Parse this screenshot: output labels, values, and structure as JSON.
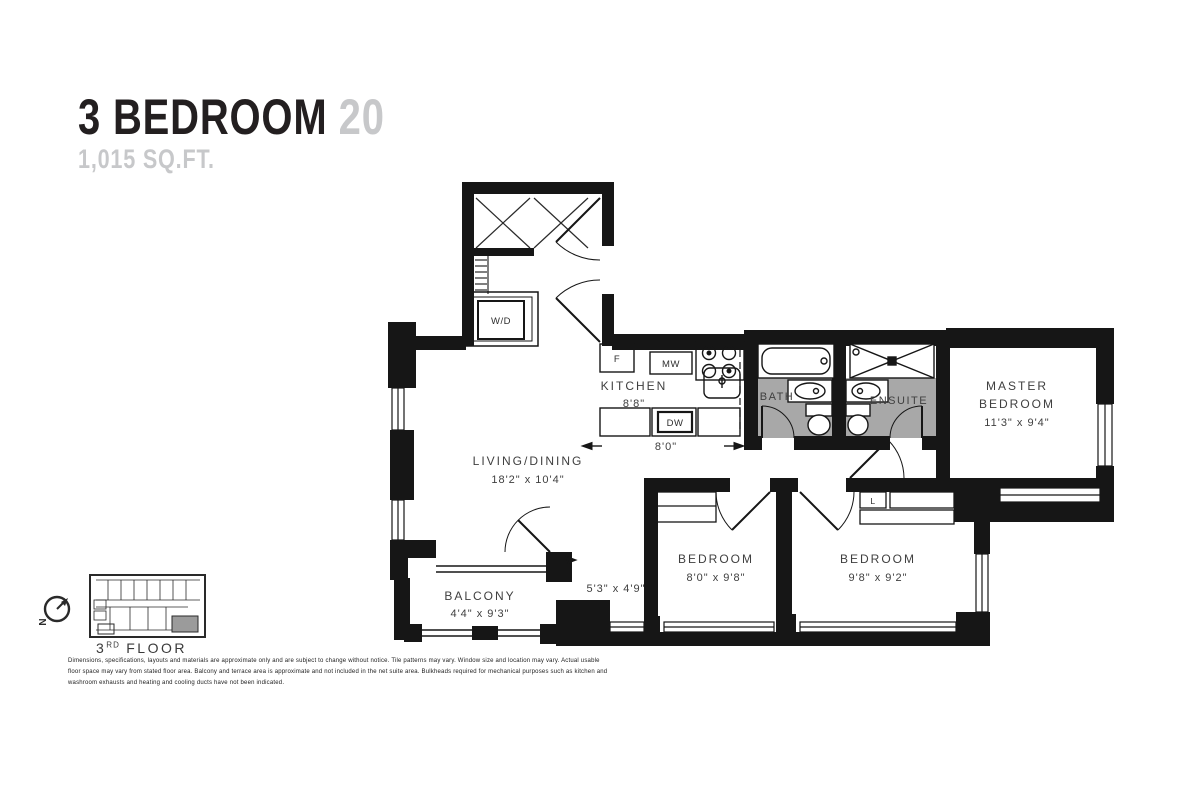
{
  "header": {
    "title_black": "3 BEDROOM",
    "title_gray": "20",
    "area": "1,015 SQ.FT."
  },
  "colors": {
    "wall": "#161616",
    "bath_floor": "#a8a8a8",
    "title_gray": "#c7c8ca"
  },
  "plan": {
    "living": {
      "name": "LIVING/DINING",
      "dims": "18'2\" x 10'4\""
    },
    "kitchen": {
      "name": "KITCHEN",
      "dims": "8'8\"",
      "width_dim": "8'0\""
    },
    "bath": {
      "name": "BATH"
    },
    "ensuite": {
      "name": "ENSUITE"
    },
    "master": {
      "line1": "MASTER",
      "line2": "BEDROOM",
      "dims": "11'3\" x 9'4\""
    },
    "bedroom_left": {
      "name": "BEDROOM",
      "dims": "8'0\" x 9'8\""
    },
    "bedroom_right": {
      "name": "BEDROOM",
      "dims": "9'8\" x 9'2\""
    },
    "balcony": {
      "name": "BALCONY",
      "dims": "4'4\" x 9'3\""
    },
    "den": {
      "dims": "5'3\" x 4'9\""
    },
    "appliances": {
      "fridge": "F",
      "microwave": "MW",
      "dishwasher": "DW",
      "washer_dryer": "W/D",
      "linen": "L"
    }
  },
  "keyplan": {
    "floor_number": "3",
    "floor_ordinal": "RD",
    "floor_word": "FLOOR",
    "north": "N"
  },
  "disclaimer": {
    "text": "Dimensions, specifications, layouts and materials are approximate only and are subject to change without notice. Tile patterns may vary. Window size and location may vary. Actual usable floor space may vary from stated floor area. Balcony and terrace area is approximate and not included in the net suite area. Bulkheads required for mechanical purposes such as kitchen and washroom exhausts and heating and cooling ducts have not been indicated."
  }
}
